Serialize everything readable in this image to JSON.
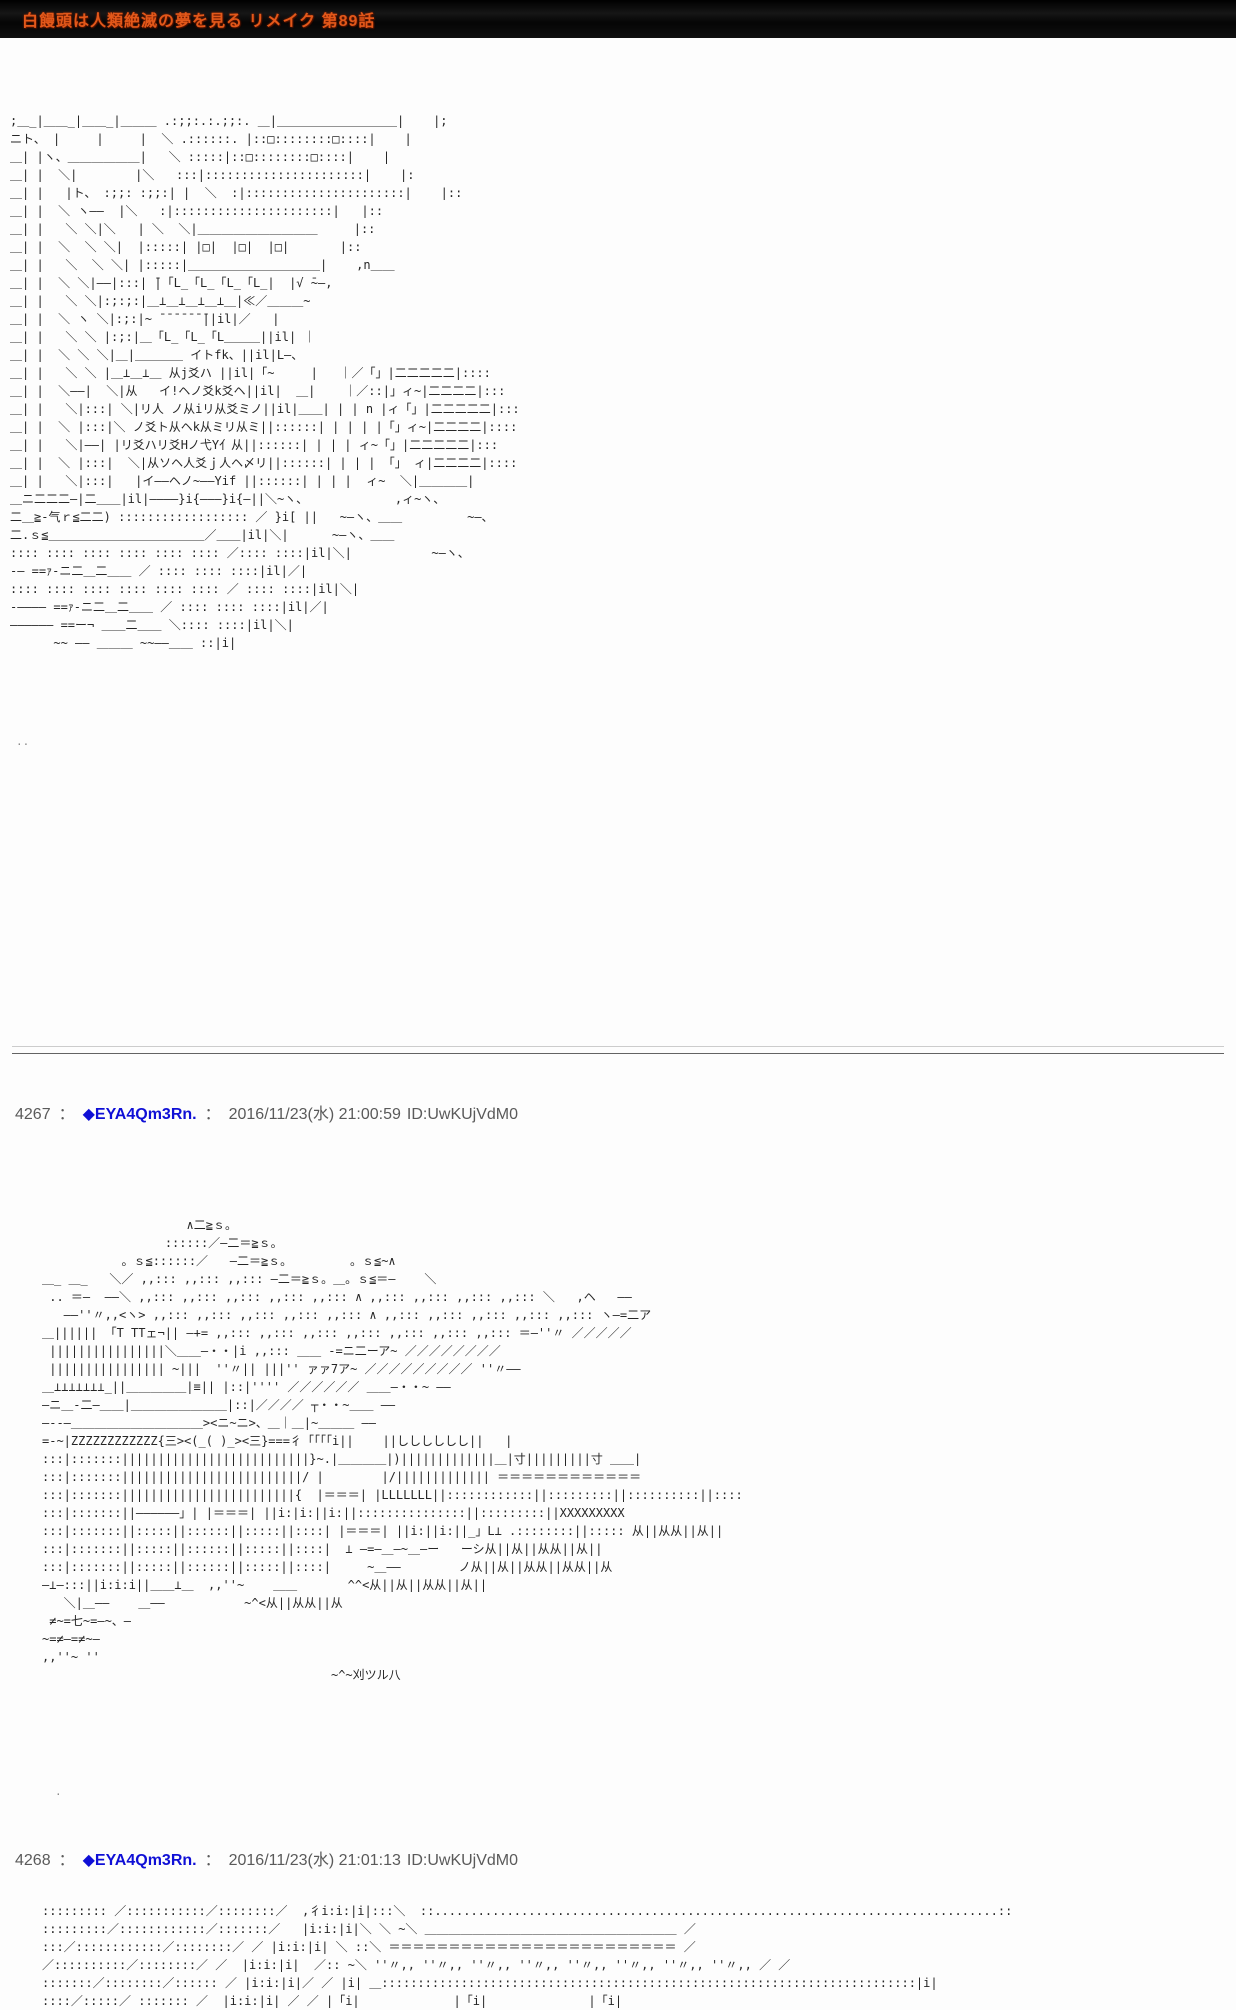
{
  "titlebar": {
    "title": "白饅頭は人類絶滅の夢を見る リメイク 第89話"
  },
  "stray": {
    "top_dots": "..",
    "mid_dot": "."
  },
  "posts": [
    {
      "number": "4267",
      "sep": "：",
      "name": "◆EYA4Qm3Rn.",
      "datetime": "2016/11/23(水) 21:00:59",
      "id": "ID:UwKUjVdM0"
    },
    {
      "number": "4268",
      "sep": "：",
      "name": "◆EYA4Qm3Rn.",
      "datetime": "2016/11/23(水) 21:01:13",
      "id": "ID:UwKUjVdM0"
    }
  ],
  "aa": {
    "block1": [
      ";＿_|＿＿_|＿＿_|＿＿＿ .:;;:.:.;;:. ＿|＿＿＿＿＿＿＿＿＿＿|    |;",
      "ニト、 |     |     |  ＼ .::::::. |::□::::::::□::::|    |",
      "＿| |ヽ、＿＿＿＿＿＿|   ＼ :::::|::□::::::::□::::|    |",
      "＿| |  ＼|        |＼   :::|::::::::::::::::::::::|    |:",
      "＿| |   |ト、 :;;: :;;:| |  ＼  :|::::::::::::::::::::::|    |::",
      "＿| |  ＼ ヽ——  |＼   :|::::::::::::::::::::::|   |::",
      "＿| |   ＼ ＼|＼   | ＼  ＼|＿＿＿＿＿＿＿＿＿＿     |::",
      "＿| |  ＼  ＼ ＼|  |:::::| |□|  |□|  |□|       |::",
      "＿| |   ＼  ＼ ＼| |:::::|＿＿＿＿＿＿＿＿＿＿＿|    ,n＿＿",
      "＿| |  ＼ ＼|——|:::| ̄|「L_「L_「L_「L_|  |√ ̄~–,",
      "＿| |   ＼ ＼|:;:;:|＿⊥＿⊥＿⊥＿⊥＿|≪／＿＿＿~",
      "＿| |  ＼ ヽ ＼|:;:|~ ̄ ̄ ̄ ̄ ̄ ̄ ̄||il|／   |",
      "＿| |   ＼ ＼ |:;:|＿「L_「L_「L＿＿＿||il| ｜",
      "＿| |  ＼ ＼ ＼|＿|＿＿＿＿ イトfk、||il|L—、",
      "＿| |   ＼ ＼ |＿⊥＿⊥＿ 从j爻ハ ||il|「~     |   ｜／「」|二二二二二|::::",
      "＿| |  ＼——|  ＼|从   イ!ヘノ爻k爻ヘ||il|  ＿|    ｜／::|」ィ~|二二二二|:::",
      "＿| |   ＼|:::| ＼|リ人 ノ从iリ从爻ミノ||il|＿＿| | | n |ィ「」|二二二二二|:::",
      "＿| |  ＼ |:::|＼ ノ爻ト从ヘk从ミリ从ミ||::::::| | | | |「」ィ~|二二二二|::::",
      "＿| |   ＼|——| |リ爻ハリ爻Hノ弋Y亻从||::::::| | | | ィ~「」|二二二二二|:::",
      "＿| |  ＼ |:::|  ＼|从ソヘ人爻ｊ人ヘ〆リ||::::::| | | | 「」 ィ|二二二二|::::",
      "＿| |   ＼|:::|   |イ――ヘノ~――Yif ||::::::| | | |  ィ~  ＼|＿＿＿＿|",
      "＿ニ二二二—|二＿＿|il|————}i{———}i{–||＼~ヽ、            ,ィ~ヽ、",
      "二＿≧-气ｒ≦二二) :::::::::::::::::: ／ }i[ ||   ~–ヽ、＿＿         ~–、",
      "二.ｓ≦＿＿＿＿＿＿＿＿＿＿＿＿＿／＿＿|il|＼|      ~–ヽ、＿＿",
      ":::: :::: :::: :::: :::: :::: ／:::: ::::|il|＼|           ~–ヽ、",
      "-— ==ｧ‐ニ二＿二＿＿ ／ :::: :::: ::::|il|／|",
      ":::: :::: :::: :::: :::: :::: ／ :::: ::::|il|＼|",
      "-–––– ==ｧ‐ニ二＿二＿＿ ／ :::: :::: ::::|il|／|",
      "―――――― ==ー¬ ＿＿二＿＿ ＼:::: ::::|il|＼|",
      "      ~~ ―― ＿＿＿ ~~——＿＿ ::|i|"
    ],
    "block2": [
      "                    ∧二≧ｓ。",
      "                 ::::::／–二＝≧ｓ。",
      "           。ｓ≦::::::／   –二＝≧ｓ。        。ｓ≦~∧",
      "＿_ ＿_   ＼／ ,,::: ,,::: ,,::: –二＝≧ｓ。＿。ｓ≦＝–    ＼",
      " .. ＝–  ——＼ ,,::: ,,::: ,,::: ,,::: ,,::: ∧ ,,::: ,,::: ,,::: ,,::: ＼   ,ヘ   ——",
      "   ——''〃,,<ヽ> ,,::: ,,::: ,,::: ,,::: ,,::: ∧ ,,::: ,,::: ,,::: ,,::: ,,::: ヽ–=二ア",
      "＿|||||| 「T TTェ¬|| —+= ,,::: ,,::: ,,::: ,,::: ,,::: ,,::: ,,::: ＝—''〃 ／／／／／",
      " ||||||||||||||||＼＿＿—・・|i ,,::: ＿＿ ‐=ニ二ーア~ ／／／／／／／／",
      " |||||||||||||||| ~|||  ''〃|| |||'' ァァ7ア~ ／／／／／／／／／ ''〃——",
      "＿⊥⊥⊥⊥⊥⊥⊥_||＿＿＿＿＿|≡|| |::|'''' ／／／／／／ ＿＿—・・~ ——",
      "–ニ＿‐二—＿＿|＿＿＿＿＿＿＿＿|::|／／／／ ┬・・~＿＿ ——",
      "—--—＿＿＿＿＿＿＿＿＿＿＿><ニ~ニ>、＿｜＿|~＿＿＿ ——",
      "=-~|ZZZZZZZZZZZZ{三><(_( )_><三}===彳「「「「i||    ||しししししし||   |",
      ":::|:::::::||||||||||||||||||||||||||}~.|＿＿＿＿|)|||||||||||||＿|寸|||||||||寸 ＿＿|",
      ":::|:::::::|||||||||||||||||||||||||/ |        |/||||||||||||| ＝＝＝＝＝＝＝＝＝＝＝＝",
      ":::|:::::::||||||||||||||||||||||||{  |＝＝＝| |LLLLLLL||::::::::::::||:::::::::||::::::::::||::::",
      ":::|:::::::||——————」| |＝＝＝| ||i:|i:||i:||:::::::::::::::||:::::::::||XXXXXXXXX",
      ":::|:::::::||:::::||::::::||:::::||::::| |＝＝＝| ||i:||i:||_」L⊥ .::::::::||::::: 从||从从||从||",
      ":::|:::::::||:::::||::::::||:::::||::::|  ⊥ —=–＿—~＿―ー   ーシ从||从||从从||从||",
      ":::|:::::::||:::::||::::::||:::::||::::|     ~＿——        ノ从||从||从从||从从||从",
      "—⊥—:::||i:i:i||＿＿⊥＿  ,,''~    ＿＿       ^^<从||从||从从||从||",
      "   ＼|＿——    ＿——           ~^<从||从从||从",
      " ≠~=七~=–~、—",
      "~=≠–=≠~–",
      ",,''~ ''",
      "                                        ~^~刈ツル八"
    ],
    "block3": [
      "::::::::: ／:::::::::::／::::::::／  ,彳i:i:|i|:::＼  ::..............................................................................::",
      ":::::::::／::::::::::::／:::::::／   |i:i:|i|＼ ＼ ~＼ ＿＿＿＿＿＿＿＿＿＿＿＿＿＿＿＿＿＿＿＿＿ ／",
      ":::／::::::::::::／::::::::／ ／ |i:i:|i| ＼ ::＼ ＝＝＝＝＝＝＝＝＝＝＝＝＝＝＝＝＝＝＝＝＝＝＝＝ ／",
      "／::::::::::／::::::::／ ／  |i:i:|i|  ／:: ~＼ ''〃,, ''〃,, ''〃,, ''〃,, ''〃,, ''〃,, ''〃,, ''〃,, ／ ／",
      ":::::::／::::::::／:::::: ／ |i:i:|i|／ ／ |i| ＿::::::::::::::::::::::::::::::::::::::::::::::::::::::::::::::::::::::::::|i|",
      "::::／:::::／ ::::::: ／  |i:i:|i| ／ ／ |「i|             |「i|              |「i|"
    ]
  }
}
